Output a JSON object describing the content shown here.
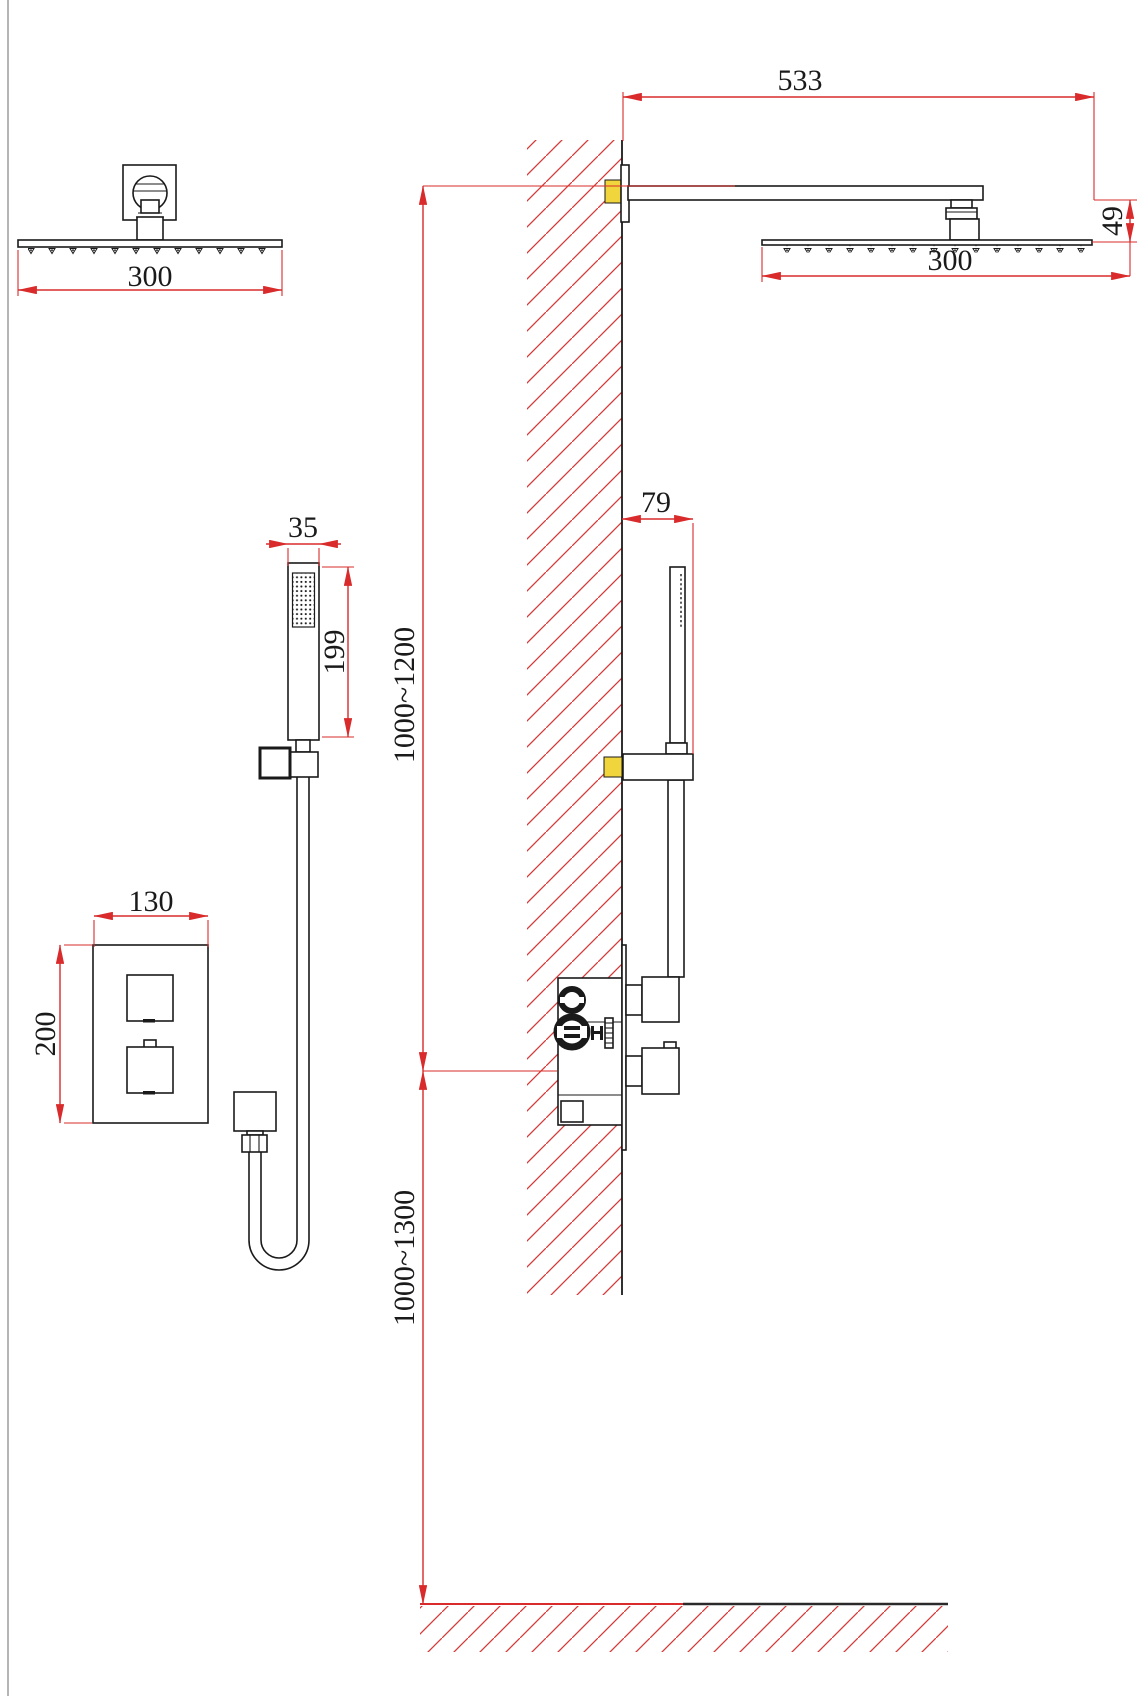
{
  "drawing": {
    "type": "shower-system-installation-technical-drawing",
    "views": {
      "front_rain_head": "rain shower head front view",
      "side_elevation": "wall-mounted shower system side view",
      "hand_shower_front": "hand shower front view",
      "valve_front": "thermostatic valve trim front view"
    }
  },
  "colors": {
    "dimension_red": "#d92b2b",
    "hatch_red": "#d43a3a",
    "outline_black": "#1a1a1a",
    "anchor_yellow": "#f0d53c"
  },
  "dimensions": {
    "front_head_width": "300",
    "side_arm_length": "533",
    "side_head_width": "300",
    "side_head_drop": "49",
    "hand_shower_width": "35",
    "hand_shower_length": "199",
    "valve_plate_width": "130",
    "valve_plate_height": "200",
    "bar_wall_offset": "79",
    "arm_above_valve_range": "1000~1200",
    "valve_above_floor_range": "1000~1300"
  }
}
